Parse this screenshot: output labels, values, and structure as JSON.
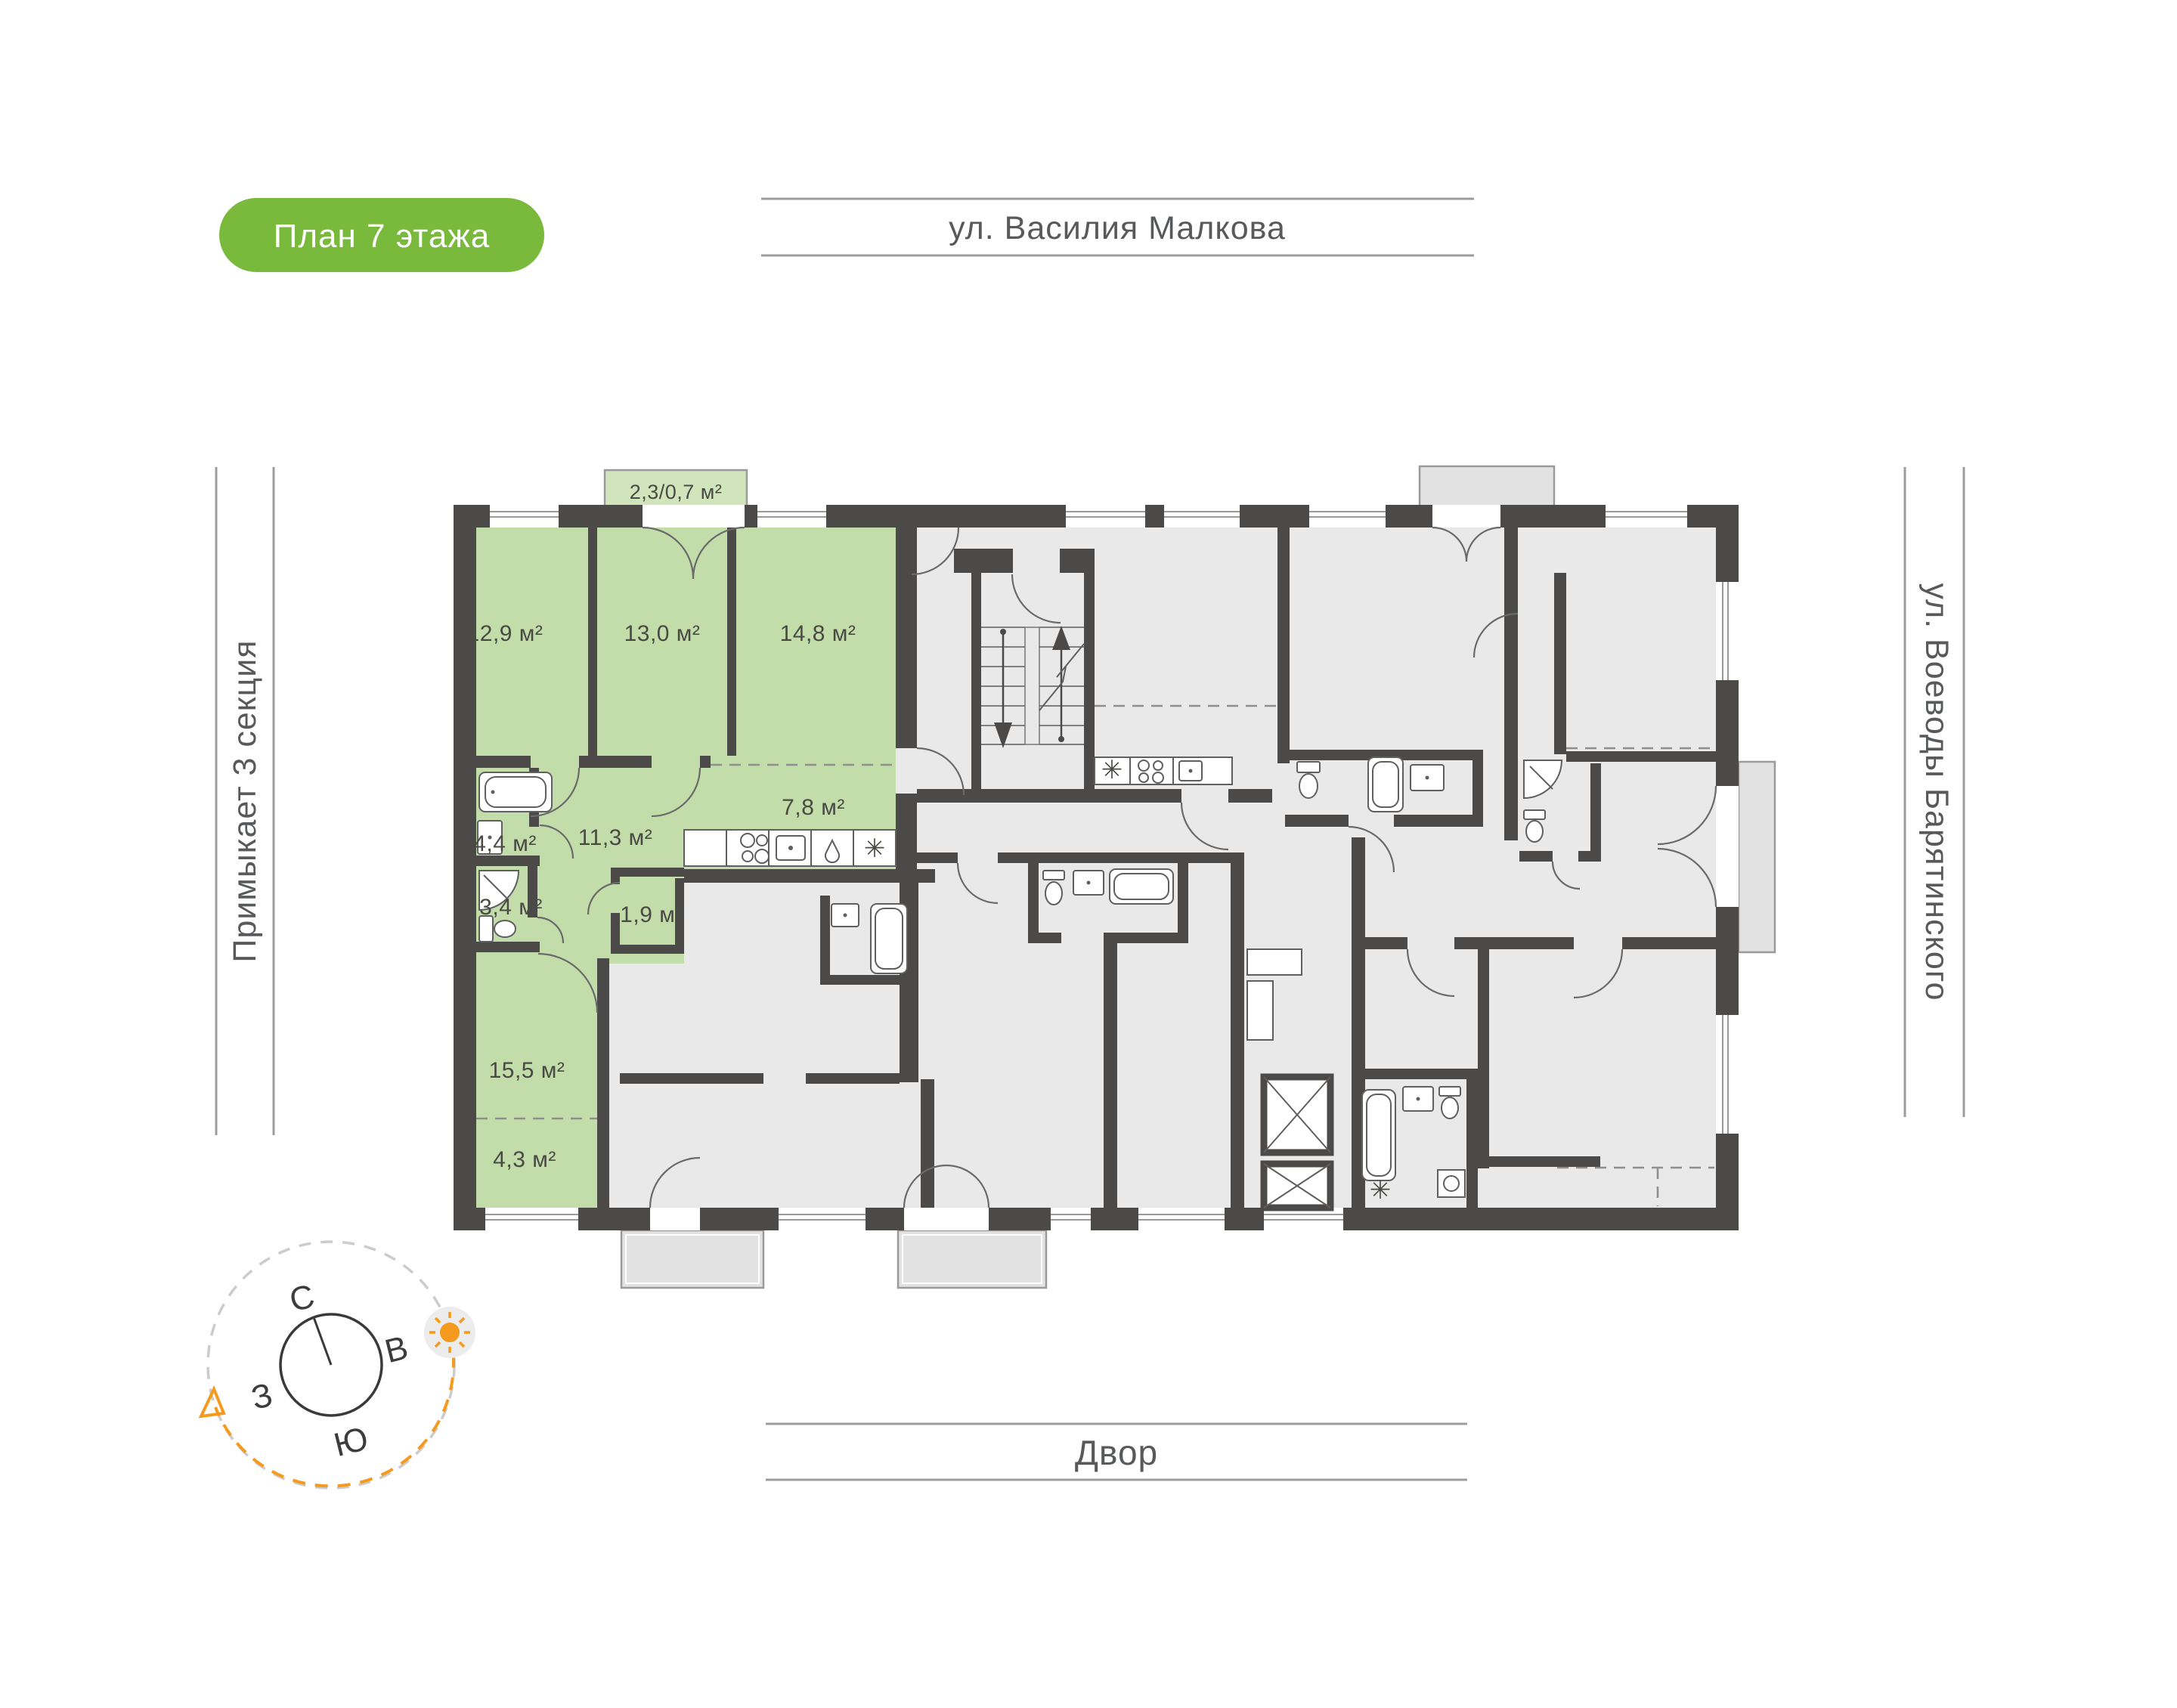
{
  "header_pill": {
    "label": "План 7 этажа",
    "bg": "#79b93c",
    "text_color": "#ffffff"
  },
  "streets": {
    "top": "ул. Василия Малкова",
    "bottom": "Двор",
    "left": "Примыкает 3 секция",
    "right": "ул. Воеводы Барятинского"
  },
  "apartment": {
    "highlight_color": "#c2dcaa",
    "balcony_color": "#d0e5bb",
    "rooms": [
      {
        "id": "bedroom-1",
        "area": "12,9 м²"
      },
      {
        "id": "bedroom-2",
        "area": "13,0 м²"
      },
      {
        "id": "bedroom-3",
        "area": "14,8 м²"
      },
      {
        "id": "kitchen",
        "area": "7,8 м²"
      },
      {
        "id": "bathroom",
        "area": "4,4 м²"
      },
      {
        "id": "hallway",
        "area": "11,3 м²"
      },
      {
        "id": "shower-room",
        "area": "3,4 м²"
      },
      {
        "id": "wardrobe",
        "area": "1,9 м²"
      },
      {
        "id": "living-room",
        "area": "15,5 м²"
      },
      {
        "id": "loggia-zone",
        "area": "4,3 м²"
      },
      {
        "id": "balcony",
        "area": "2,3/0,7 м²"
      }
    ]
  },
  "compass": {
    "north": "С",
    "east": "В",
    "west": "З",
    "south": "Ю"
  },
  "glyphs": {
    "snowflake": "✳"
  },
  "colors": {
    "wall": "#4b4a48",
    "room_gray": "#e9e9e9",
    "accent_green": "#79b93c",
    "orange": "#f49b1f"
  }
}
